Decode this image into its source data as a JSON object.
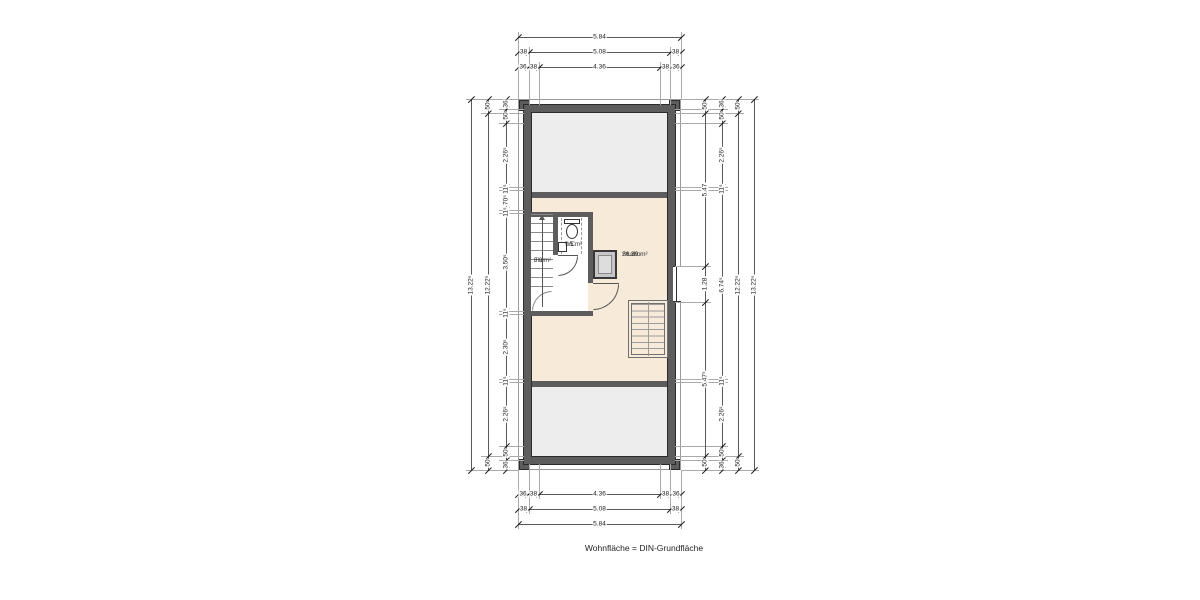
{
  "caption": "Wohnfläche = DIN-Grundfläche",
  "rooms": {
    "flur": {
      "name": "Flur",
      "area": "3.9 m²"
    },
    "wc": {
      "name": "WC",
      "area": "1.5 m²"
    },
    "studio": {
      "name": "Studio",
      "area": "26.39 m²"
    }
  },
  "colors": {
    "paper": "#ffffff",
    "wall": "#5d5d5d",
    "attic": "#ededed",
    "living": "#f8ead9"
  },
  "dims": {
    "horizontal": [
      {
        "y": 37,
        "x": [
          518,
          681
        ],
        "labels": [
          "5.84"
        ]
      },
      {
        "y": 52,
        "x": [
          518,
          529,
          670,
          681
        ],
        "labels": [
          "38",
          "5.08",
          "38"
        ]
      },
      {
        "y": 67,
        "x": [
          518,
          528,
          539,
          660,
          671,
          681
        ],
        "labels": [
          "36",
          "38",
          "4.36",
          "38",
          "36"
        ]
      },
      {
        "y": 494,
        "x": [
          518,
          528,
          539,
          660,
          671,
          681
        ],
        "labels": [
          "36",
          "38",
          "4.36",
          "38",
          "36"
        ]
      },
      {
        "y": 509,
        "x": [
          518,
          529,
          670,
          681
        ],
        "labels": [
          "38",
          "5.08",
          "38"
        ]
      },
      {
        "y": 524,
        "x": [
          518,
          681
        ],
        "labels": [
          "5.84"
        ]
      }
    ],
    "vertical": [
      {
        "x": 471,
        "y": [
          99,
          470
        ],
        "labels": [
          "13.22⁵"
        ]
      },
      {
        "x": 488,
        "y": [
          99,
          113,
          456,
          470
        ],
        "labels": [
          "50",
          "12.22⁵",
          "50"
        ]
      },
      {
        "x": 506,
        "y": [
          99,
          109,
          123,
          187,
          190,
          210,
          213,
          311,
          314,
          379,
          382,
          446,
          460,
          470
        ],
        "labels": [
          "36",
          "50",
          "2.26⁵",
          "11⁵",
          "70⁵",
          "11⁵",
          "3.50⁵",
          "11⁵",
          "2.30⁵",
          "11⁵",
          "2.26⁵",
          "50",
          "36"
        ]
      },
      {
        "x": 705,
        "y": [
          99,
          113,
          266,
          302,
          456,
          470
        ],
        "labels": [
          "50",
          "5.47",
          "1.28",
          "5.47⁵",
          "50"
        ]
      },
      {
        "x": 722,
        "y": [
          99,
          109,
          123,
          187,
          190,
          379,
          382,
          446,
          460,
          470
        ],
        "labels": [
          "36",
          "50",
          "2.26⁵",
          "11⁵",
          "6.74⁵",
          "11⁵",
          "2.26⁵",
          "50",
          "36"
        ]
      },
      {
        "x": 738,
        "y": [
          99,
          113,
          456,
          470
        ],
        "labels": [
          "50",
          "12.22⁵",
          "50"
        ]
      },
      {
        "x": 754,
        "y": [
          99,
          470
        ],
        "labels": [
          "13.22⁵"
        ]
      }
    ],
    "ext_v": [
      [
        518,
        32,
        99
      ],
      [
        681,
        32,
        99
      ],
      [
        529,
        47,
        105
      ],
      [
        670,
        47,
        105
      ],
      [
        539,
        62,
        105
      ],
      [
        660,
        62,
        105
      ],
      [
        518,
        470,
        529
      ],
      [
        681,
        470,
        529
      ],
      [
        529,
        464,
        514
      ],
      [
        670,
        464,
        514
      ],
      [
        539,
        464,
        499
      ],
      [
        660,
        464,
        499
      ]
    ],
    "ext_h": [
      [
        99,
        466,
        518
      ],
      [
        470,
        466,
        518
      ],
      [
        99,
        681,
        759
      ],
      [
        470,
        681,
        759
      ],
      [
        113,
        481,
        524
      ],
      [
        456,
        481,
        524
      ],
      [
        109,
        499,
        524
      ],
      [
        123,
        499,
        524
      ],
      [
        187,
        499,
        524
      ],
      [
        190,
        499,
        524
      ],
      [
        210,
        499,
        524
      ],
      [
        213,
        499,
        524
      ],
      [
        311,
        499,
        524
      ],
      [
        314,
        499,
        524
      ],
      [
        379,
        499,
        524
      ],
      [
        382,
        499,
        524
      ],
      [
        446,
        499,
        524
      ],
      [
        460,
        499,
        524
      ],
      [
        113,
        675,
        744
      ],
      [
        456,
        675,
        744
      ],
      [
        266,
        675,
        711
      ],
      [
        302,
        675,
        711
      ],
      [
        109,
        675,
        728
      ],
      [
        123,
        675,
        728
      ],
      [
        187,
        675,
        728
      ],
      [
        190,
        675,
        728
      ],
      [
        379,
        675,
        728
      ],
      [
        382,
        675,
        728
      ],
      [
        446,
        675,
        728
      ],
      [
        460,
        675,
        728
      ]
    ]
  }
}
